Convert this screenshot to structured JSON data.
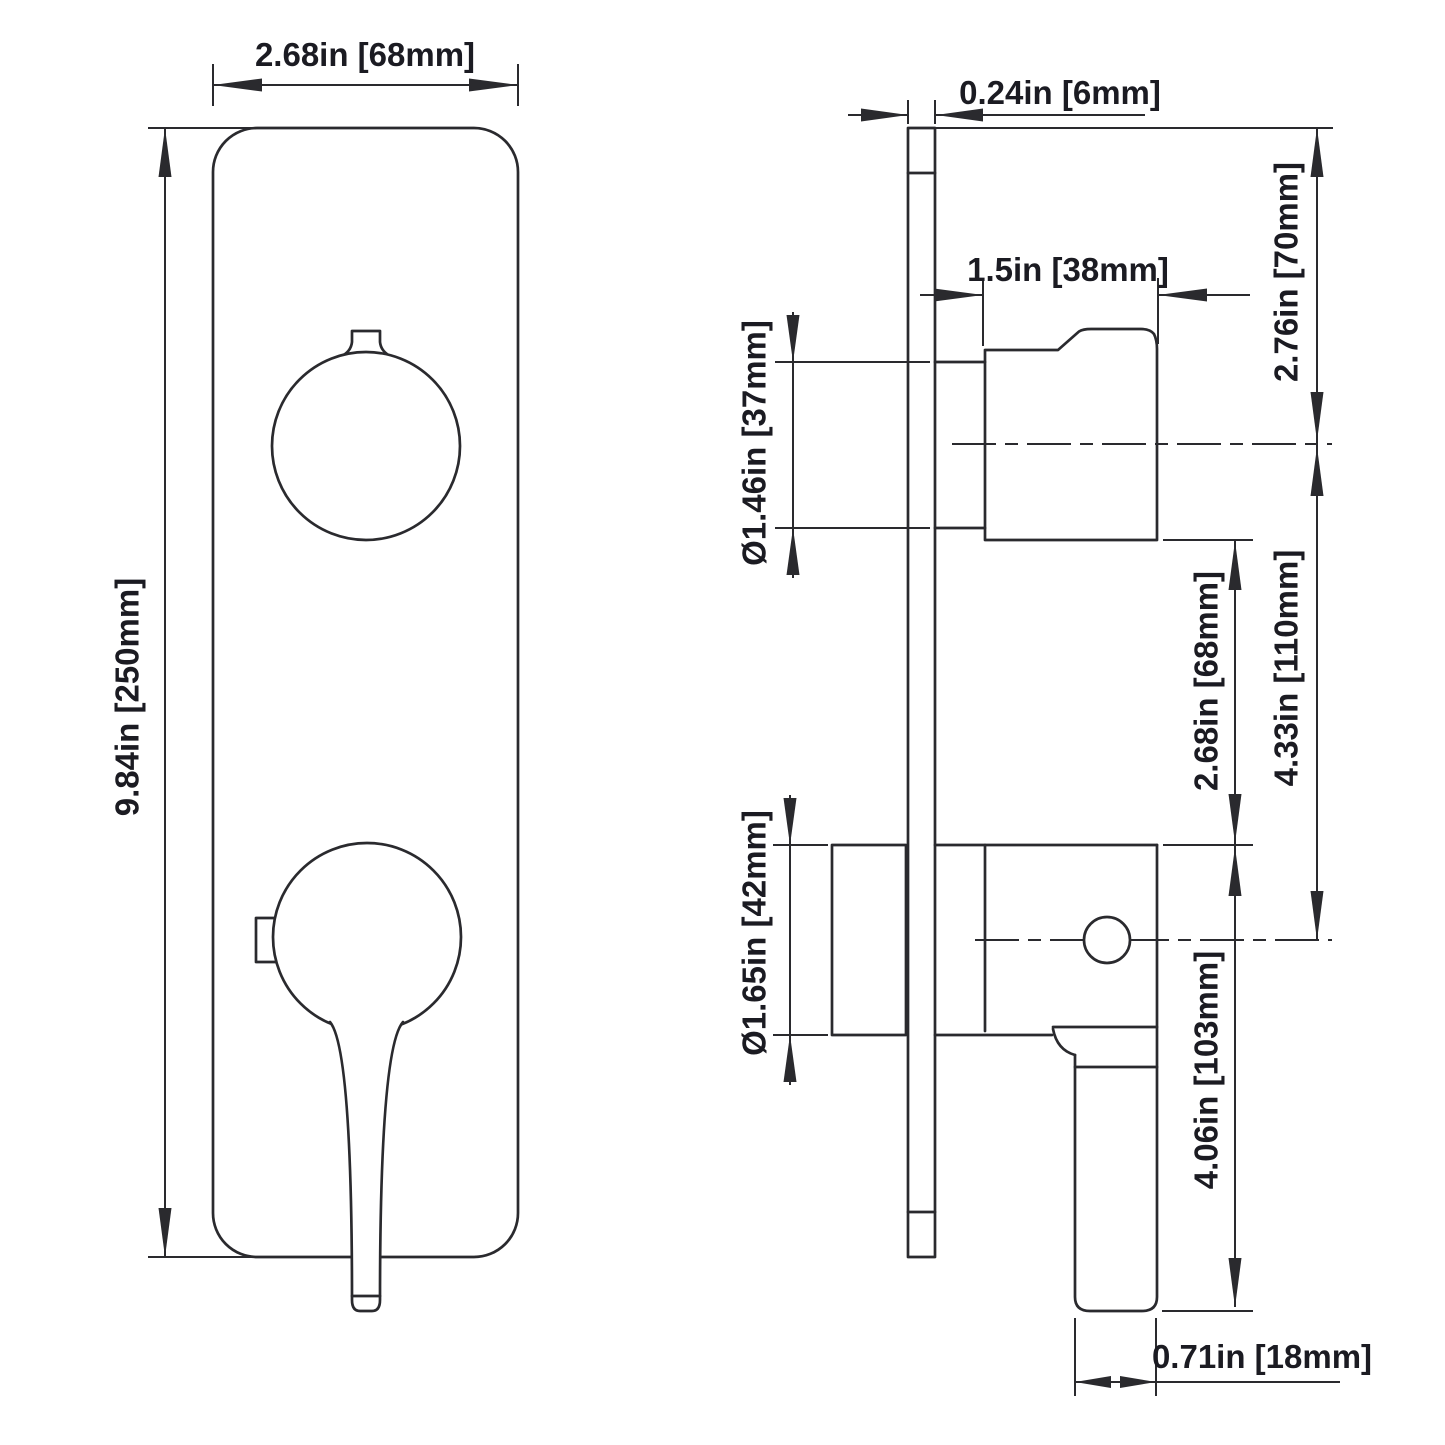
{
  "drawing": {
    "colors": {
      "line": "#2a2a2e",
      "text": "#1b1b22",
      "background": "#ffffff"
    },
    "front_view": {
      "width_label": "2.68in [68mm]",
      "height_label": "9.84in [250mm]"
    },
    "side_view": {
      "plate_thickness_label": "0.24in [6mm]",
      "knob_depth_label": "1.5in [38mm]",
      "top_offset_label": "2.76in [70mm]",
      "knob_diameter_label": "Ø1.46in [37mm]",
      "handle_gap_label": "2.68in [68mm]",
      "center_distance_label": "4.33in [110mm]",
      "handle_diameter_label": "Ø1.65in [42mm]",
      "lever_length_label": "4.06in [103mm]",
      "lever_width_label": "0.71in [18mm]"
    }
  }
}
